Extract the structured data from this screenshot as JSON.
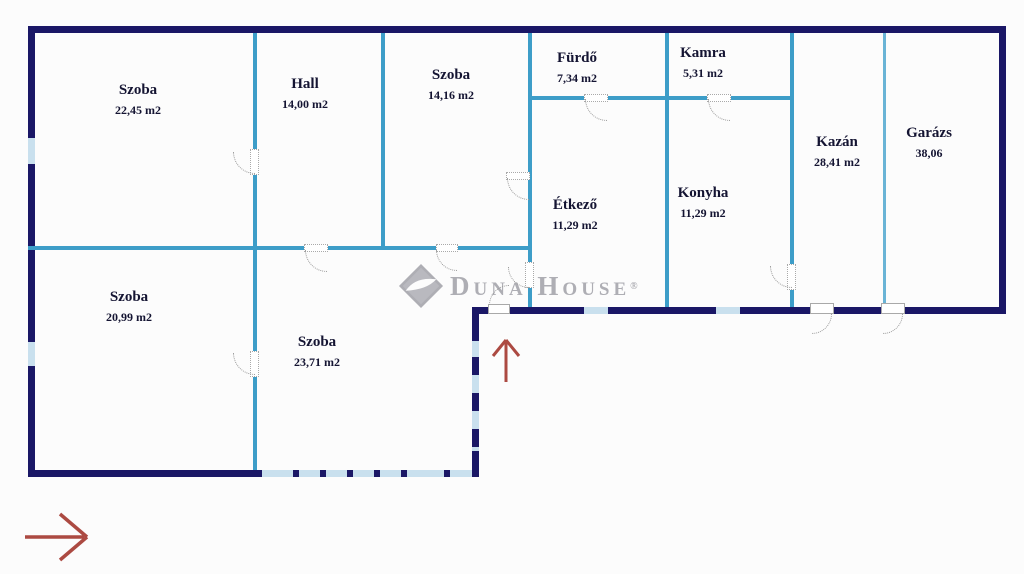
{
  "colors": {
    "outer_wall": "#1a1766",
    "inner_wall": "#3d9dc8",
    "thin_wall": "#6ab4d6",
    "window": "#c9e0ee",
    "door": "#9a9a9a",
    "arrow": "#ac4a42",
    "label": "#141432",
    "logo": "#aeaeb4"
  },
  "watermark": {
    "brand": "Duna House",
    "reg": "®"
  },
  "icons": {
    "entrance_arrow": "↑",
    "orientation_arrow": "→"
  },
  "rooms": [
    {
      "name": "Szoba",
      "area": "22,45 m2"
    },
    {
      "name": "Hall",
      "area": "14,00 m2"
    },
    {
      "name": "Szoba",
      "area": "14,16 m2"
    },
    {
      "name": "Fürdő",
      "area": "7,34 m2"
    },
    {
      "name": "Kamra",
      "area": "5,31 m2"
    },
    {
      "name": "Kazán",
      "area": "28,41 m2"
    },
    {
      "name": "Garázs",
      "area": "38,06"
    },
    {
      "name": "Étkező",
      "area": "11,29 m2"
    },
    {
      "name": "Konyha",
      "area": "11,29 m2"
    },
    {
      "name": "Szoba",
      "area": "20,99 m2"
    },
    {
      "name": "Szoba",
      "area": "23,71 m2"
    }
  ]
}
